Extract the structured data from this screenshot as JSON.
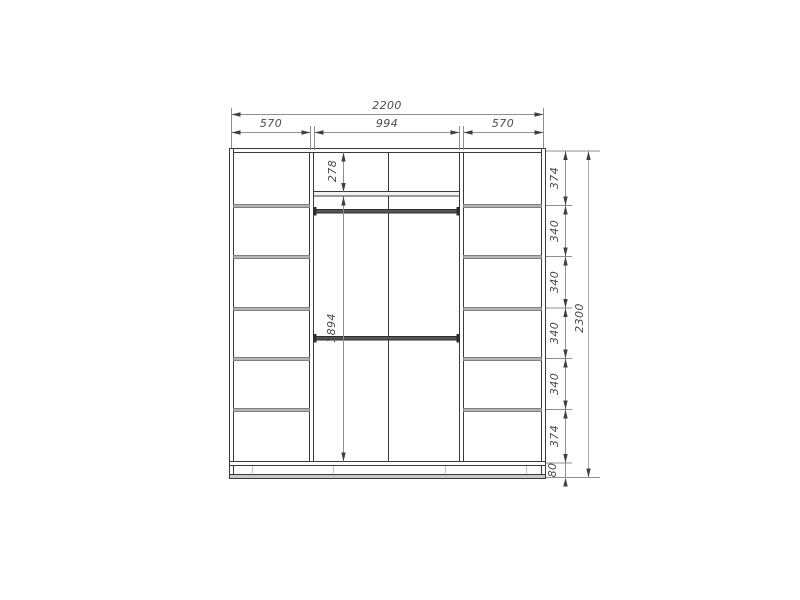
{
  "drawing": {
    "kind": "wardrobe-front-elevation",
    "dims": {
      "width_total": "2200",
      "width_left": "570",
      "width_middle": "994",
      "width_right": "570",
      "height_total": "2300",
      "upper_shelf_height": "278",
      "hanging_space_height": "1894",
      "right_chain": [
        "374",
        "340",
        "340",
        "340",
        "340",
        "374",
        "80"
      ]
    },
    "colors": {
      "background": "#ffffff",
      "structure_line": "#3a3a3a",
      "dimension_line": "#8f8f8f",
      "dimension_text": "#4a4a4a",
      "shelf_fill": "#b4b4b4",
      "rod_fill": "#565656",
      "plinth_fill": "#c9c9c9"
    }
  }
}
